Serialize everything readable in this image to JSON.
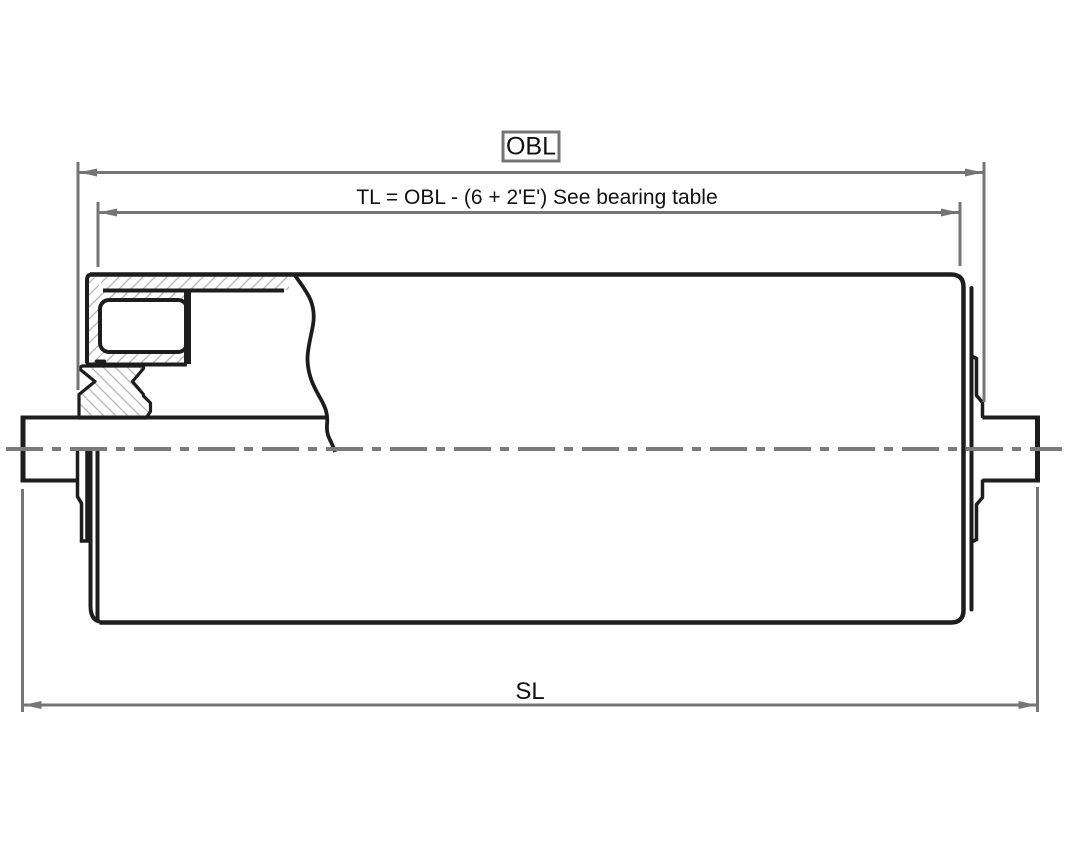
{
  "drawing": {
    "type": "engineering-cross-section",
    "subject": "conveyor-roller-with-bearing-detail",
    "dimensions": {
      "obl_label": "OBL",
      "tl_label": "TL = OBL - (6 + 2'E') See bearing table",
      "sl_label": "SL"
    },
    "colors": {
      "outline": "#1d1d1d",
      "dimension": "#757575",
      "hatch": "#b5b5b5",
      "background": "#ffffff"
    }
  }
}
